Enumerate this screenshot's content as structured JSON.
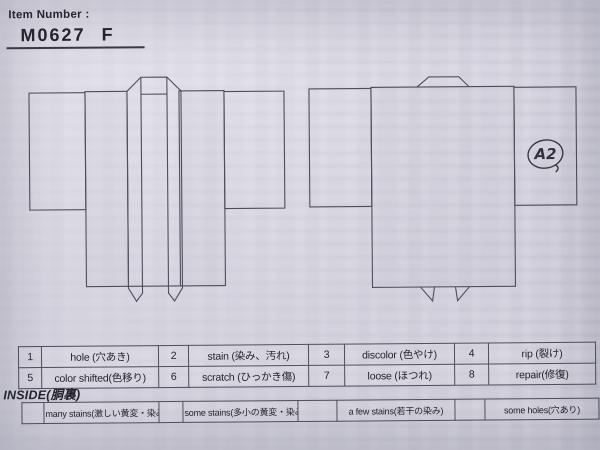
{
  "page": {
    "paper_color": "#d9d8e2",
    "line_color": "#4e4d5b",
    "ink_color": "#24242c",
    "annotation_ink": "#3a3a44"
  },
  "header": {
    "label": "Item Number :",
    "item_number": "M0627",
    "size_code": "F"
  },
  "annotation": {
    "text": "A2"
  },
  "condition_codes": [
    {
      "num": "1",
      "label": "hole (穴あき)"
    },
    {
      "num": "2",
      "label": "stain (染み、汚れ)"
    },
    {
      "num": "3",
      "label": "discolor (色やけ)"
    },
    {
      "num": "4",
      "label": "rip (裂け)"
    },
    {
      "num": "5",
      "label": "color shifted(色移り)"
    },
    {
      "num": "6",
      "label": "scratch (ひっかき傷)"
    },
    {
      "num": "7",
      "label": "loose (ほつれ)"
    },
    {
      "num": "8",
      "label": "repair(修復)"
    }
  ],
  "inside_label": "INSIDE(胴裏)",
  "stain_scale": [
    "many stains(激しい黄変・染み)",
    "some stains(多小の黄変・染み)",
    "a few stains(若干の染み)",
    "some holes(穴あり)"
  ]
}
